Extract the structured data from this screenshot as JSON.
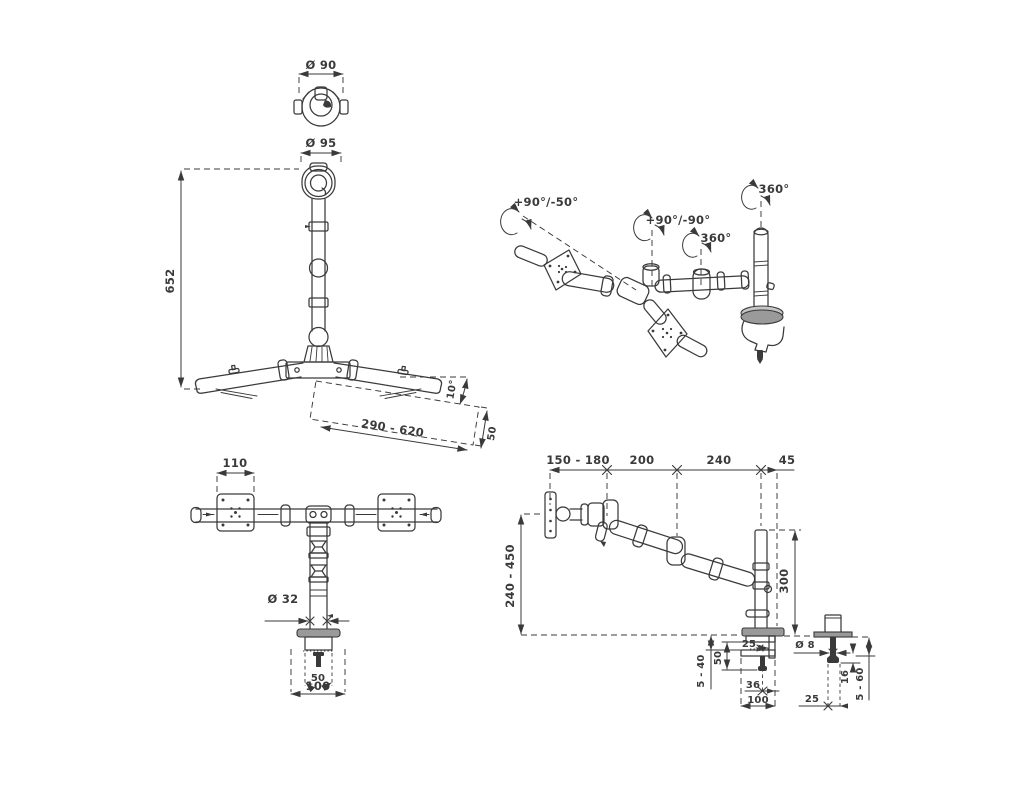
{
  "drawing": {
    "colors": {
      "ink": "#3a3a3a",
      "background": "#ffffff",
      "metal_fill": "#9a9a9a"
    },
    "top_view": {
      "diameter_label": "Ø 90"
    },
    "front_view": {
      "head_diameter_label": "Ø 95",
      "height_label": "652",
      "tilt_label": "10°",
      "reach_label": "290 - 620",
      "end_width_label": "50"
    },
    "perspective_view": {
      "tilt_range_label": "+90°/-50°",
      "pivot_range_label": "+90°/-90°",
      "arm_rotation_label": "360°",
      "pole_rotation_label": "360°"
    },
    "bottom_front_view": {
      "vesa_width_label": "110",
      "pole_diameter_label": "Ø 32",
      "clamp_inner_label": "50",
      "clamp_width_label": "100"
    },
    "side_view": {
      "seg1_label": "150 - 180",
      "seg2_label": "200",
      "seg3_label": "240",
      "seg4_label": "45",
      "height_range_label": "240 - 450",
      "pole_height_label": "300",
      "jaw_depth_label": "25",
      "desk_thickness_label": "5 - 40",
      "throat_label": "50",
      "bolt_offset_label": "36",
      "base_width_label": "100"
    },
    "bolt_detail": {
      "bolt_diameter_label": "Ø 8",
      "below_desk_label": "16",
      "desk_range_label": "5 - 60",
      "offset_label": "25"
    }
  }
}
